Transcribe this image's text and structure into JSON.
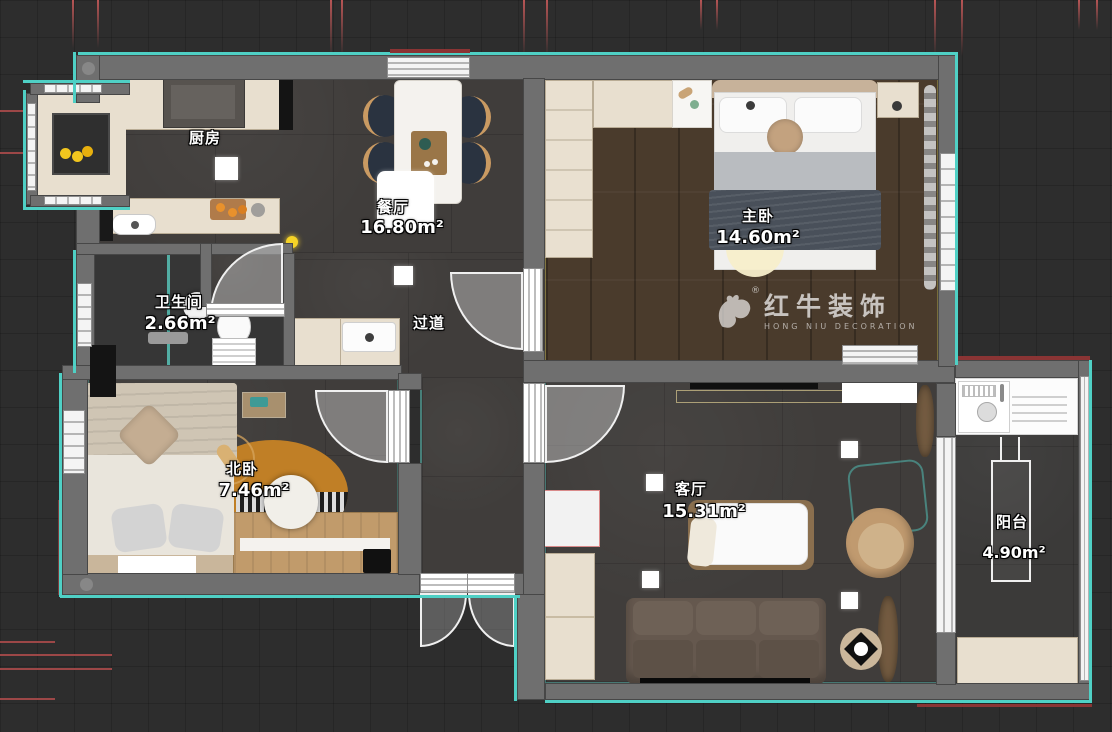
{
  "canvas": {
    "width": 1112,
    "height": 732
  },
  "rooms": {
    "kitchen": {
      "label": "厨房"
    },
    "dining": {
      "label": "餐厅",
      "area": "16.80m²"
    },
    "master_bedroom": {
      "label": "主卧",
      "area": "14.60m²"
    },
    "bathroom": {
      "label": "卫生间",
      "area": "2.66m²"
    },
    "hallway": {
      "label": "过道"
    },
    "north_bedroom": {
      "label": "北卧",
      "area": "7.46m²"
    },
    "living_room": {
      "label": "客厅",
      "area": "15.31m²"
    },
    "balcony": {
      "label": "阳台",
      "area": "4.90m²"
    }
  },
  "watermark": {
    "brand": "红牛装饰",
    "subtitle": "HONG NIU DECORATION",
    "registered": "®"
  },
  "colors": {
    "wall": "#6f6f6f",
    "wall_edge_teal": "#4fd0c5",
    "construction_red": "#9c4747",
    "floor_tile_dark": "#403d3b",
    "floor_wood_dark": "#4a3b2c",
    "floor_wood_light": "#c19b6b",
    "cabinet_beige": "#e8dfcf",
    "rug_orange": "#c07f26",
    "sofa_brown": "#65584e",
    "chair_navy": "#2a3340"
  }
}
